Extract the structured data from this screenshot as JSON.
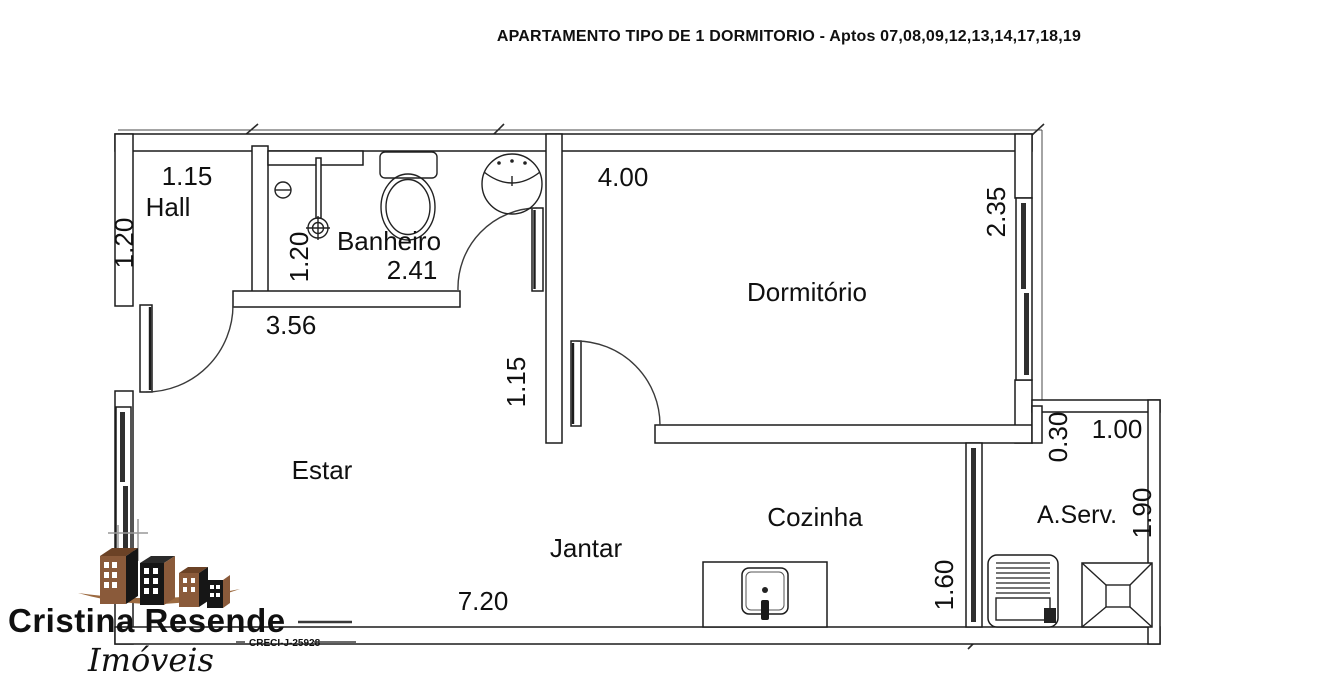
{
  "header": {
    "title": "APARTAMENTO TIPO DE 1 DORMITORIO - Aptos 07,08,09,12,13,14,17,18,19"
  },
  "plan": {
    "rooms": {
      "hall": "Hall",
      "banheiro": "Banheiro",
      "dormitorio": "Dormitório",
      "estar": "Estar",
      "jantar": "Jantar",
      "cozinha": "Cozinha",
      "area_servico": "A.Serv."
    },
    "dimensions": {
      "hall_width": "1.15",
      "hall_depth": "1.20",
      "banheiro_depth": "1.20",
      "banheiro_width": "2.41",
      "estar_wall": "3.56",
      "dormitorio_width": "4.00",
      "dormitorio_depth": "2.35",
      "passage_depth": "1.15",
      "apartment_width": "7.20",
      "cozinha_depth": "1.60",
      "area_servico_recess": "0.30",
      "area_servico_width": "1.00",
      "area_servico_depth": "1.90"
    }
  },
  "logo": {
    "brand": "Cristina Resende",
    "tagline": "Imóveis",
    "license": "CRECI-J-25928",
    "colors": {
      "brand_brown": "#8a5a3a",
      "ink": "#1c1c1c"
    }
  }
}
